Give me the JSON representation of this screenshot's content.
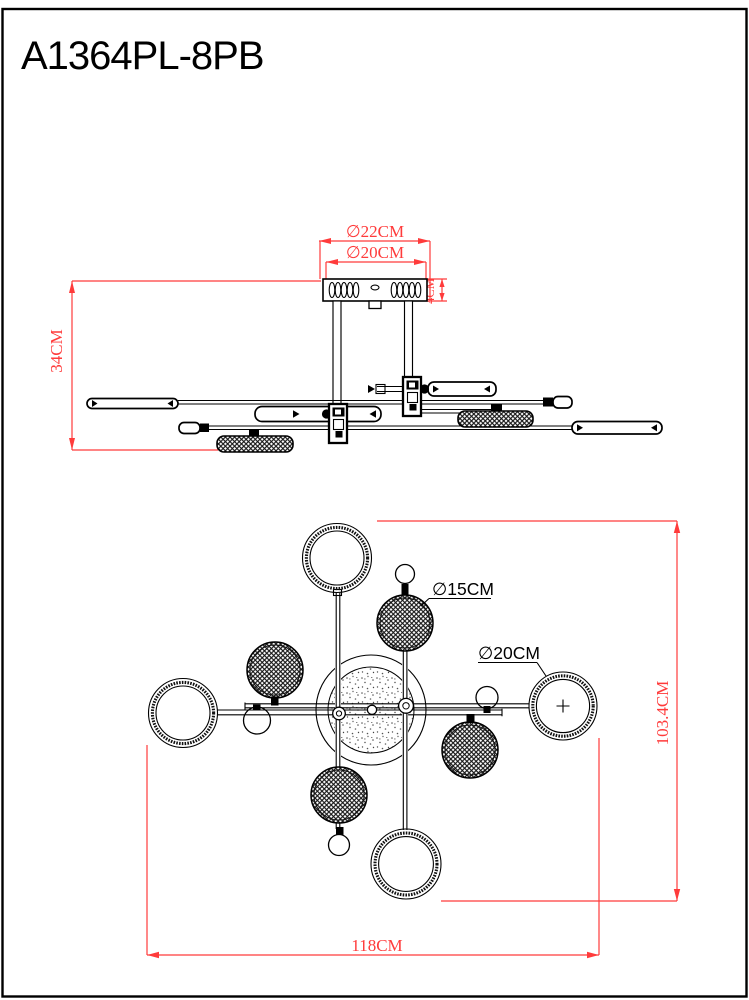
{
  "title": "A1364PL-8PB",
  "side_view": {
    "dim_canopy_outer": "∅22CM",
    "dim_canopy_inner": "∅20CM",
    "dim_canopy_height": "4CM",
    "dim_drop": "34CM"
  },
  "plan_view": {
    "label_mesh_diameter": "∅15CM",
    "label_ring_diameter": "∅20CM",
    "dim_height": "103.4CM",
    "dim_width": "118CM"
  },
  "colors": {
    "dimension_red": "#ff3b3b",
    "drawing_black": "#000000",
    "background": "#ffffff"
  }
}
